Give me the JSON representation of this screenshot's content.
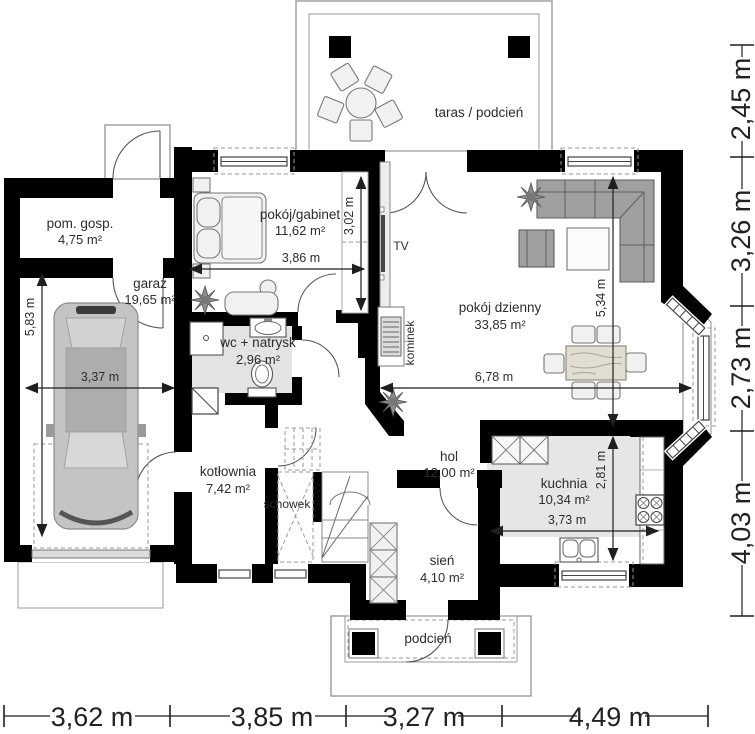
{
  "rooms": {
    "pom_gosp": {
      "name": "pom. gosp.",
      "area": "4,75 m²"
    },
    "garaz": {
      "name": "garaż",
      "area": "19,65 m²"
    },
    "pokoj_gabinet": {
      "name": "pokój/gabinet",
      "area": "11,62 m²"
    },
    "wc_natrysk": {
      "name": "wc + natrysk",
      "area": "2,96 m²"
    },
    "kotlownia": {
      "name": "kotłownia",
      "area": "7,42 m²"
    },
    "pokoj_dzienny": {
      "name": "pokój dzienny",
      "area": "33,85 m²"
    },
    "hol": {
      "name": "hol",
      "area": "12,00 m²"
    },
    "kuchnia": {
      "name": "kuchnia",
      "area": "10,34 m²"
    },
    "sien": {
      "name": "sień",
      "area": "4,10 m²"
    }
  },
  "labels": {
    "taras": "taras / podcień",
    "podcien": "podcień",
    "schowek": "schowek",
    "tv": "TV",
    "kominek": "kominek"
  },
  "dimensions": {
    "interior": {
      "garage_width": "3,37 m",
      "garage_depth": "5,83 m",
      "bedroom_width": "3,86 m",
      "bedroom_depth": "3,02 m",
      "living_width": "6,78 m",
      "living_depth": "5,34 m",
      "kitchen_width": "3,73 m",
      "kitchen_depth": "2,81 m"
    },
    "right": {
      "r1": "2,45 m",
      "r2": "3,26 m",
      "r3": "2,73 m",
      "r4": "4,03 m"
    },
    "bottom": {
      "b1": "3,62 m",
      "b2": "3,85 m",
      "b3": "3,27 m",
      "b4": "4,49 m"
    }
  },
  "colors": {
    "wall": "#000000",
    "floor_accent": "#e3e3e3",
    "furniture": "#a6a6a6",
    "line": "#555555"
  }
}
